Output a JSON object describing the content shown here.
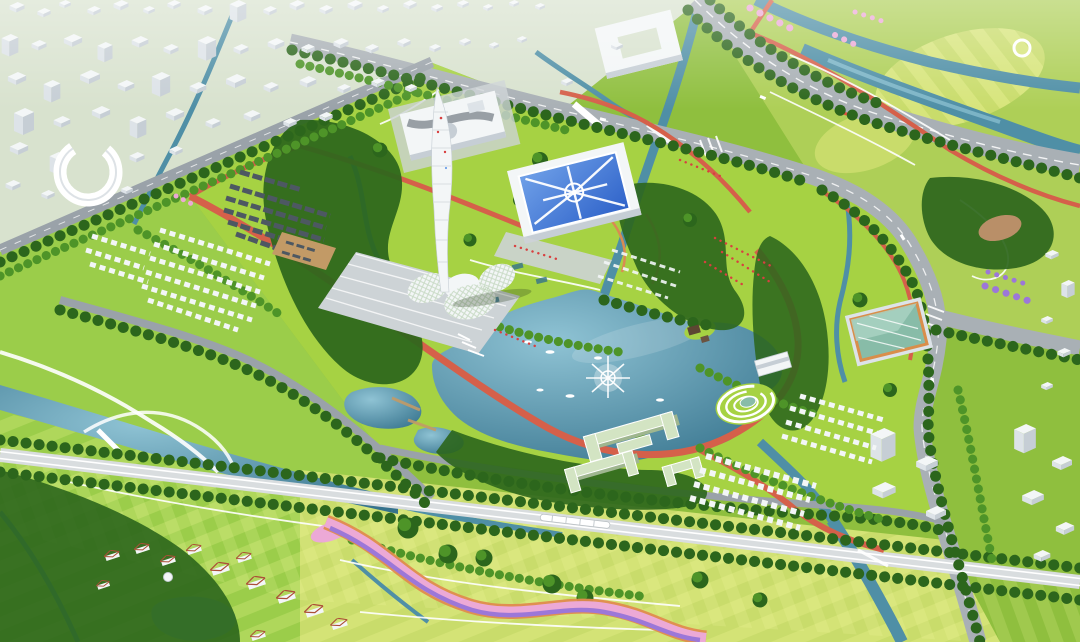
{
  "scene": {
    "type": "aerial-masterplan-rendering",
    "landmarks": [
      "observation-tower",
      "petal-exhibition-hall",
      "museum-with-round-courtyard",
      "blue-sunburst-convention-hall",
      "central-lake",
      "lake-fountain",
      "traditional-courtyard-village",
      "white-housing-grid",
      "green-roof-campus",
      "spiral-amphitheatre",
      "lakeside-pavilion",
      "teal-glass-gallery",
      "ring-building",
      "white-city-blocks",
      "riverside-park",
      "rail-corridor-with-train",
      "flower-ribbon-meadow",
      "red-roof-village",
      "wetland-ponds"
    ]
  },
  "palette": {
    "grass_base": "#8FBF3E",
    "grass_park": "#A6D243",
    "grass_meadow": "#C9DC6B",
    "grass_field": "#9ECF4C",
    "city_ground": "#D8E2CE",
    "wood_dark": "#2C661C",
    "wood_mid": "#4E9428",
    "wood_light": "#77B94A",
    "water_hi": "#8FC3D4",
    "water_lo": "#35728C",
    "water_stream": "#4F8FA6",
    "pond_green": "#7FB89A",
    "road_main": "#A9B0B5",
    "road_minor": "#9AA2A9",
    "rail_pale": "#D9DDDF",
    "plaza_gray": "#CDD3D6",
    "path_white": "#FFFFFF",
    "path_red": "#D5604A",
    "path_orange": "#D98B52",
    "bldg_white": "#F3F6F7",
    "bldg_side": "#C6CED5",
    "bldg_front": "#DDE3E8",
    "roof_dark": "#4D5862",
    "roof_tan": "#C29A66",
    "dirt_tan": "#B98F68",
    "roof_blue": "#2E62C9",
    "roof_blue_hi": "#6FA0E8",
    "roof_pale_green": "#D3E4C3",
    "roof_pale_shadow": "#9FB68F",
    "roof_terracotta": "#AC4F38",
    "glass_teal": "#88BCA8",
    "frame_orange": "#D98E4A",
    "blossom_pink": "#ECA9D6",
    "blossom_purple": "#9C77D8",
    "flower_orange": "#E08B4E",
    "crowd_red": "#D84040",
    "haze_white": "#FFFFFF"
  }
}
